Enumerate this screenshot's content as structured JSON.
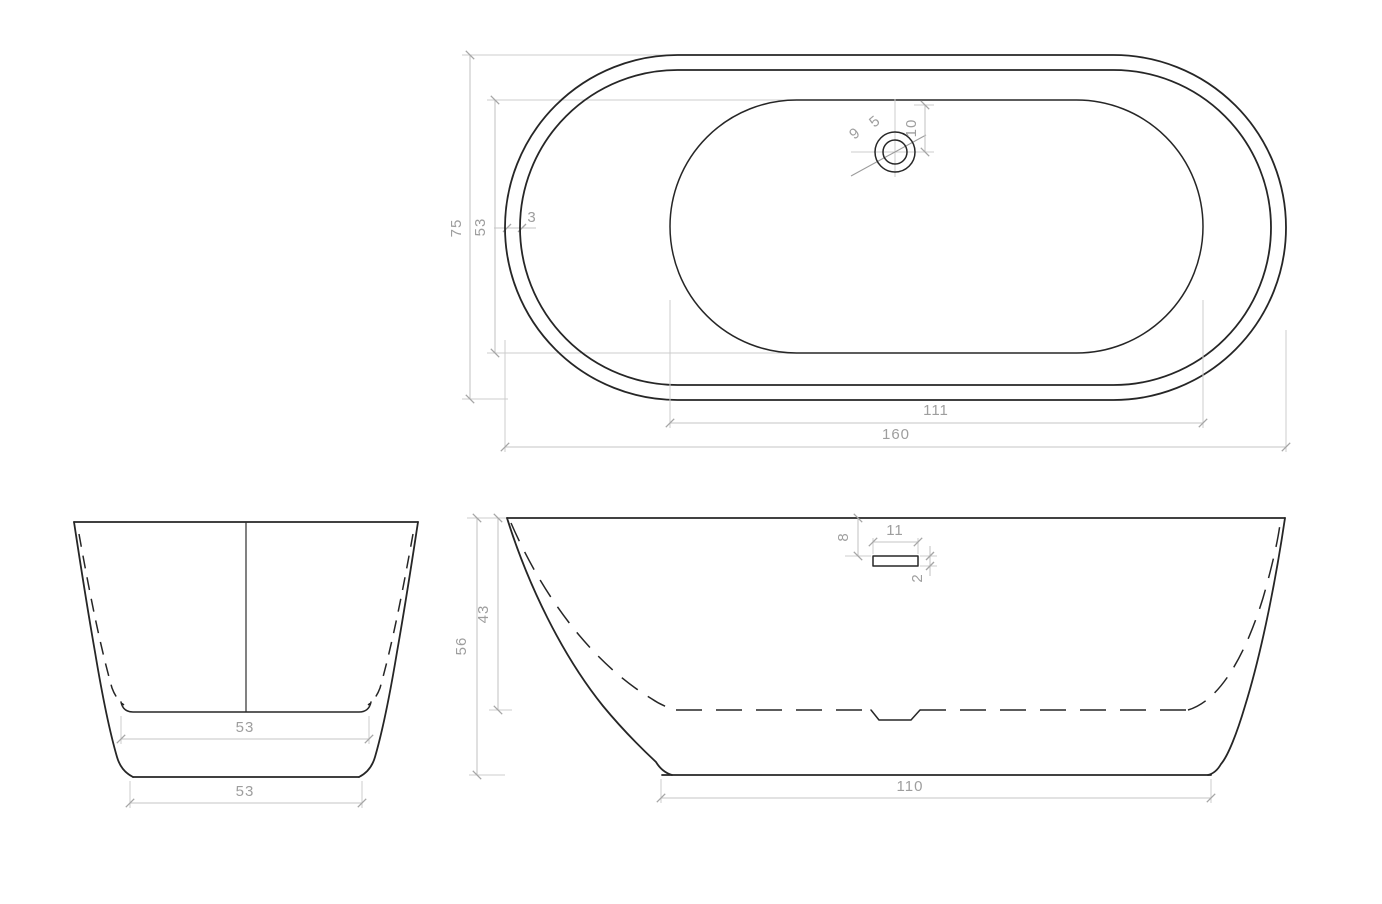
{
  "drawing": {
    "kind": "technical-drawing",
    "subject": "freestanding oval bathtub - orthographic dimension drawing",
    "units": "cm",
    "colors": {
      "outline": "#262626",
      "dimension_line": "#c6c6c6",
      "dimension_text": "#9e9e9e",
      "background": "#ffffff"
    },
    "views": {
      "top": {
        "label": "top view",
        "dims": {
          "overall_length": "160",
          "overall_width": "75",
          "basin_length": "111",
          "basin_width": "53",
          "rim_thickness": "3",
          "drain_outer_diameter": "9",
          "drain_inner_diameter": "5",
          "drain_offset": "10"
        }
      },
      "front": {
        "label": "front view",
        "dims": {
          "inner_floor_width": "53",
          "base_width": "53"
        }
      },
      "side": {
        "label": "side view",
        "dims": {
          "overall_height": "56",
          "inner_depth": "43",
          "overflow_offset_from_rim": "8",
          "overflow_width": "11",
          "overflow_height": "2",
          "base_length": "110"
        }
      }
    }
  }
}
